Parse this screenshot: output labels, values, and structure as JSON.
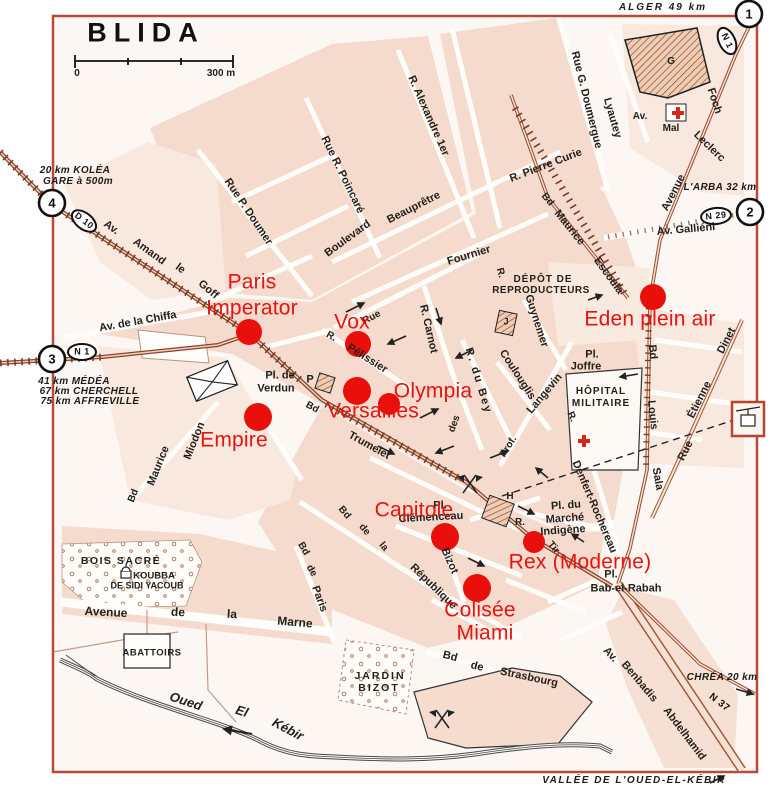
{
  "title": "BLIDA",
  "scale": {
    "zero": "0",
    "end": "300 m"
  },
  "exits": {
    "e1": "1",
    "e2": "2",
    "e3": "3",
    "e4": "4"
  },
  "badges": {
    "n1_top": "N 1",
    "d10": "D 10",
    "n1_west": "N 1",
    "n29": "N 29",
    "n37": "N 37"
  },
  "notes": {
    "alger": "ALGER 49 km",
    "kolea_1": "20 km KOLÉA",
    "kolea_2": "GARE à 500m",
    "medea": "41 km MÉDÉA",
    "cherchell": "67 km CHERCHELL",
    "affreville": "75 km AFFREVILLE",
    "larba": "L'ARBA 32 km",
    "chrea": "CHRÉA 20 km",
    "vallee": "VALLÉE DE L'OUED-EL-KÉBIR"
  },
  "cinemas": {
    "dot_color": "#e9100c",
    "paris_1": "Paris",
    "paris_2": "Imperator",
    "vox": "Vox",
    "olympia": "Olympia",
    "versailles": "Versailles",
    "empire": "Empire",
    "eden": "Eden plein air",
    "capitole": "Capitole",
    "rex": "Rex (Moderne)",
    "colisee": "Colisée",
    "miami": "Miami"
  },
  "streets": {
    "doumer": "Rue P. Doumer",
    "poincare": "Rue R. Poincaré",
    "alexandre": "R. Alexandre 1er",
    "doumergue": "Rue G. Doumergue",
    "pierre_curie": "R. Pierre Curie",
    "av_lyautey": "Av.",
    "lyautey": "Lyautey",
    "mal": "Mal",
    "leclerc": "Leclerc",
    "foch": "Foch",
    "avenue_foch": "Avenue",
    "escoula_bd": "Bd",
    "escoula_maurice": "Maurice",
    "escoula": "Escoula",
    "gallieni": "Av. Galliéni",
    "beaupretre": "Beauprêtre",
    "boulevard": "Boulevard",
    "fournier": "Fournier",
    "r_depot": "R.",
    "guynemer": "Guynemer",
    "rue_frag": "Rue",
    "pelissier_r": "R.",
    "pelissier": "Pélissier",
    "carnot": "R. Carnot",
    "du_bey": "R. du Bey",
    "coulouglis": "Coulouglis",
    "des": "des",
    "prof": "Prof.",
    "langevin": "Langevin",
    "denfert_r": "R.",
    "denfert": "Denfert-Rochereau",
    "louis_bd": "Bd",
    "louis": "Louis",
    "sala": "Sala",
    "dinet_rue": "Rue",
    "dinet_etienne": "Étienne",
    "dinet": "Dinet",
    "tir_r": "R.",
    "tir": "Tir",
    "bizot": "Bizot",
    "republique_bd": "Bd",
    "republique_de": "de",
    "republique_la": "la",
    "republique": "République",
    "paris_bd": "Bd",
    "paris_de": "de",
    "paris_st": "Paris",
    "trumelet_bd": "Bd",
    "trumelet": "Trumelet",
    "miodon_bd": "Bd",
    "miodon_maurice": "Maurice",
    "miodon": "Miodon",
    "chiffa": "Av. de la Chiffa",
    "amand_av": "Av.",
    "amand": "Amand",
    "amand_le": "le",
    "goff": "Goff",
    "marne_avenue": "Avenue",
    "marne_de": "de",
    "marne_la": "la",
    "marne": "Marne",
    "strasbourg_bd": "Bd",
    "strasbourg_de": "de",
    "strasbourg": "Strasbourg",
    "benbadis_av": "Av.",
    "benbadis": "Benbadis",
    "abdelhamid": "Abdelhamid"
  },
  "places": {
    "depot_1": "DÉPÔT DE",
    "depot_2": "REPRODUCTEURS",
    "joffre_pl": "Pl.",
    "joffre": "Joffre",
    "hopital_1": "HÔPITAL",
    "hopital_2": "MILITAIRE",
    "marche_1": "Pl. du",
    "marche_2": "Marché",
    "marche_3": "Indigène",
    "clemenceau_pl": "Pl.",
    "clemenceau": "Clémenceau",
    "verdun_1": "Pl. de",
    "verdun_2": "Verdun",
    "bab_pl": "Pl.",
    "bab": "Bab-el-Rabah",
    "bois_sacre": "BOIS SACRÉ",
    "koubba_1": "KOUBBA",
    "koubba_2": "DE SIDI YACOUB",
    "abattoirs": "ABATTOIRS",
    "jardin_1": "JARDIN",
    "jardin_2": "BIZOT",
    "oued": "Oued",
    "el": "El",
    "kebir": "Kébir"
  },
  "buildings": {
    "g": "G",
    "j": "J",
    "h": "H",
    "p": "P"
  }
}
